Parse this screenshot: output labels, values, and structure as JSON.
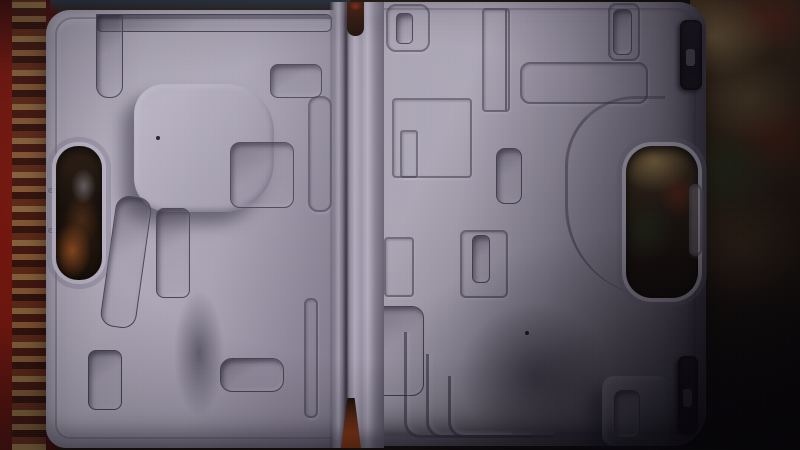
{
  "scene": {
    "description": "Dim photograph of an open, empty gray molded-plastic power tool carrying case lying on an oriental carpet; red ornamented carpet border visible along the left edge, mottled red-tan carpet pile on the right, heavy shadow over the lower-right corner",
    "visible_text": [],
    "objects": {
      "tool_case": {
        "label": "open empty molded plastic tool case",
        "material": "light gray-lavender plastic",
        "parts": [
          "left shell",
          "right shell",
          "center hinge",
          "left handle cutout",
          "right handle cutout",
          "top latch",
          "bottom latch"
        ],
        "recess_label": "molded tool recess",
        "ridge_label": "molded ridge outline",
        "details": [
          "drill-shaped recess in left shell",
          "nested L-shaped recesses in right shell",
          "carpet visible through handle cutouts and hinge gaps",
          "two small dark specks on shell floors"
        ]
      },
      "carpet": {
        "label": "oriental carpet floor",
        "features": [
          "bright red field with tan ornamented border along left edge",
          "mottled red, tan, brown and dark green pile on right side",
          "orange carpet sliver visible through bottom hinge gap"
        ]
      }
    },
    "lighting": "single dim light from upper left, strong shadow falling across lower right"
  },
  "colors": {
    "case-plastic-light": "#b4aec0",
    "case-plastic-mid": "#9c96a8",
    "case-plastic-dark": "#7b7587",
    "case-line": "#4a4456",
    "carpet-red": "#7d180e",
    "carpet-tan": "#96824e",
    "carpet-brown": "#4a3420",
    "carpet-green": "#2c381c",
    "carpet-dark": "#140d08",
    "latch-dark": "#16121a",
    "handle-hole-brown": "#21140c",
    "hinge-gap-orange": "#7c3514"
  }
}
